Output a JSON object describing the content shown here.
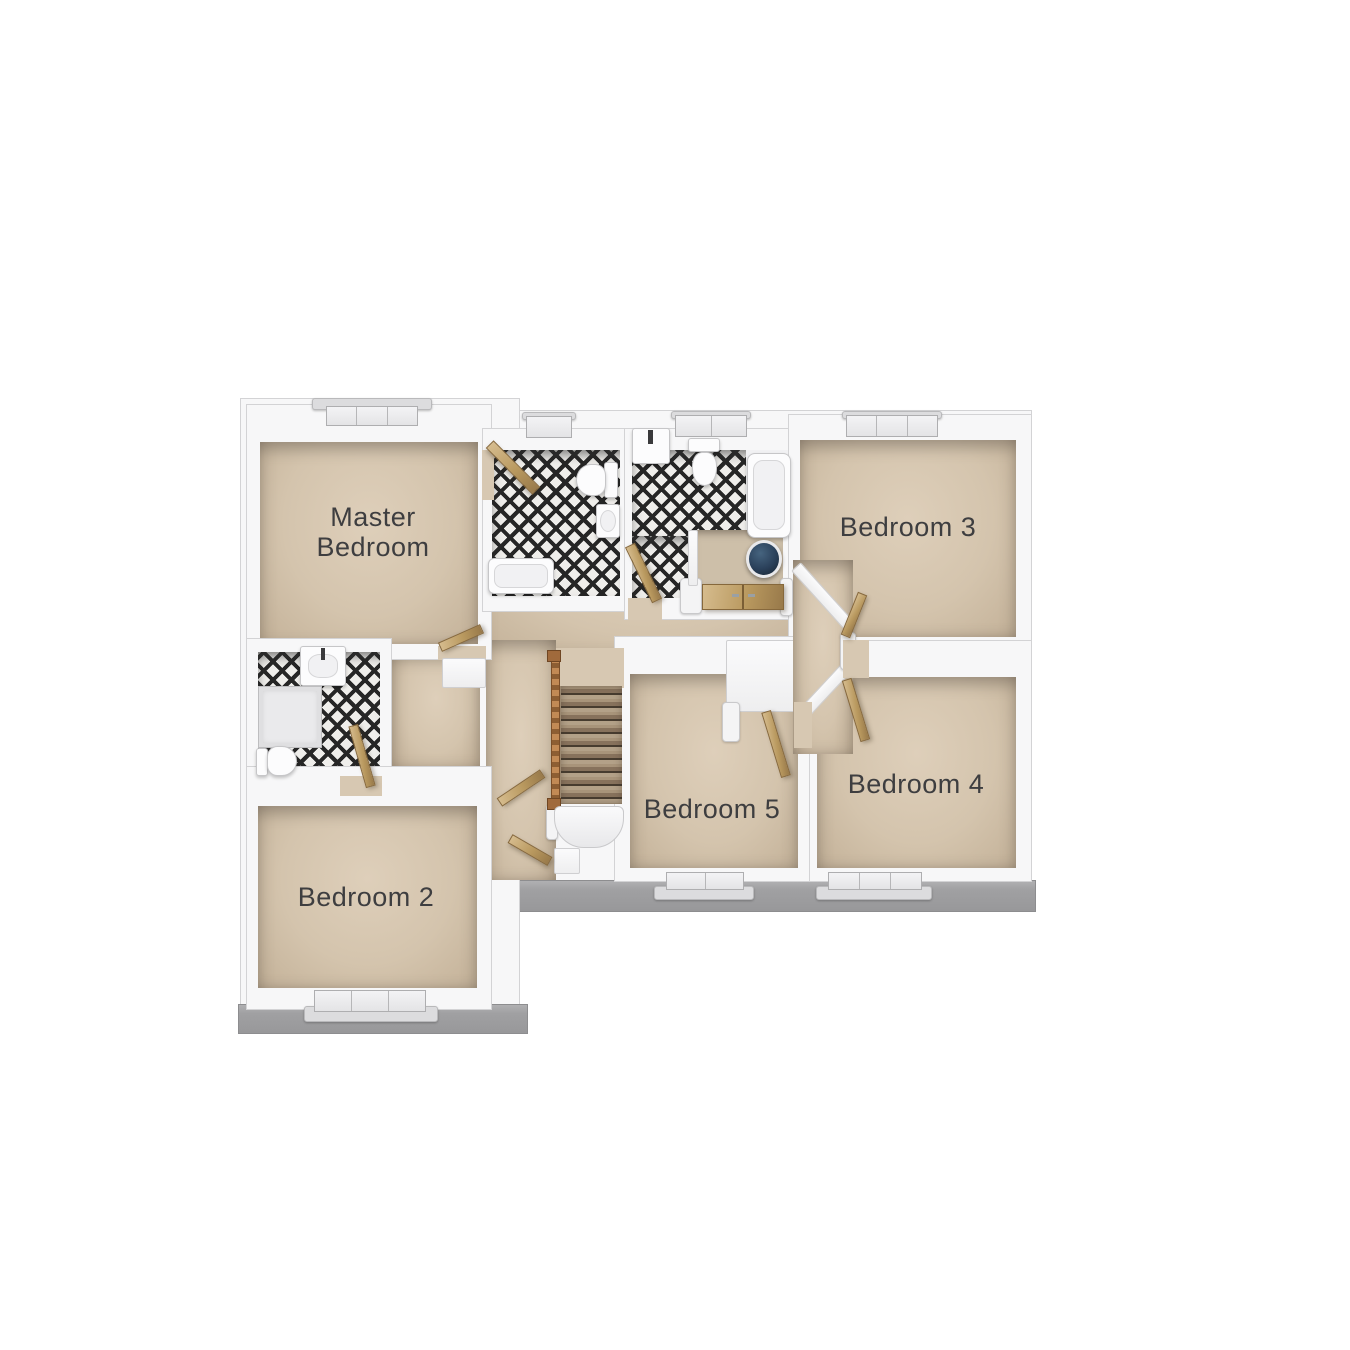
{
  "floorplan": {
    "rooms": [
      {
        "id": "master-bedroom",
        "label": "Master Bedroom"
      },
      {
        "id": "bedroom-2",
        "label": "Bedroom 2"
      },
      {
        "id": "bedroom-3",
        "label": "Bedroom 3"
      },
      {
        "id": "bedroom-4",
        "label": "Bedroom 4"
      },
      {
        "id": "bedroom-5",
        "label": "Bedroom 5"
      }
    ],
    "fixtures": [
      "bathtub",
      "toilet",
      "basin",
      "shower-enclosure",
      "hot-water-cylinder",
      "staircase",
      "wood-door",
      "window",
      "airing-cupboard-doors",
      "roof-eaves"
    ],
    "colors": {
      "background": "#ffffff",
      "wall_white": "#f7f7f8",
      "floor_beige": "#d4c4ad",
      "tile_dark": "#262626",
      "tile_light": "#efeeeb",
      "door_wood": "#b9995f",
      "eaves_gray": "#a0a0a2",
      "cylinder_navy": "#2a405a",
      "label_text": "#3e3e40"
    }
  }
}
